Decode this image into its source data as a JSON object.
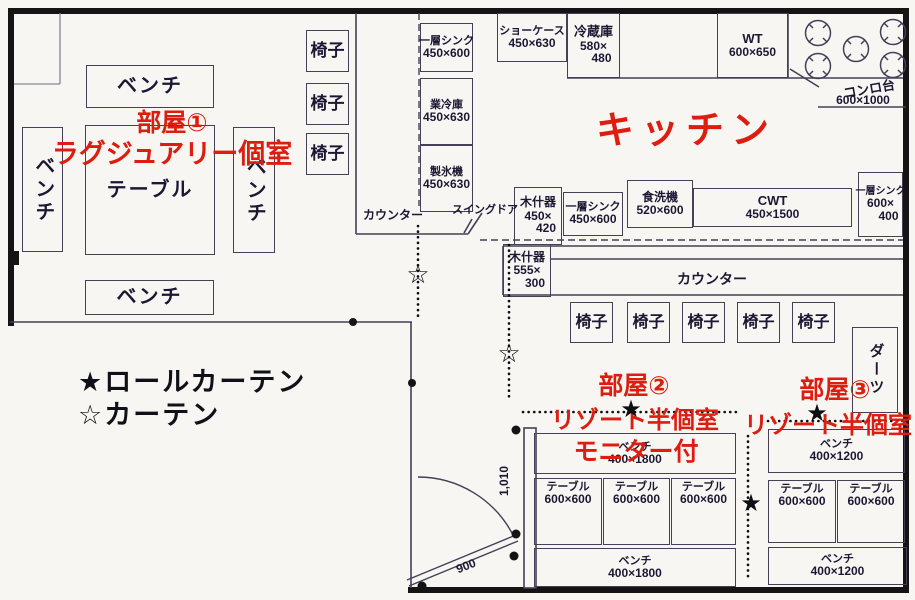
{
  "colors": {
    "accent_red": "#dd1d10",
    "line": "#463f56",
    "wall": "#141414",
    "paper": "#f8f6f2"
  },
  "legend": {
    "roll_curtain": "★ロールカーテン",
    "curtain": "☆カーテン"
  },
  "symbols": {
    "roll_curtain": "★",
    "curtain": "☆"
  },
  "room1": {
    "title": "部屋①",
    "subtitle": "ラグジュアリー個室",
    "bench": "ベンチ",
    "table": "テーブル",
    "chair": "椅子"
  },
  "kitchen": {
    "title": "キッチン",
    "counter": "カウンター",
    "counter_left": "カウンター",
    "swing_door": "スイングドア",
    "chair": "椅子",
    "darts": "ダーツ",
    "sink_left": {
      "name": "一層シンク",
      "dims": "450×600"
    },
    "cooler": {
      "name": "業冷庫",
      "dims": "450×630"
    },
    "ice_maker": {
      "name": "製氷機",
      "dims": "450×630"
    },
    "showcase": {
      "name": "ショーケース",
      "dims": "450×630"
    },
    "refrigerator": {
      "name": "冷蔵庫",
      "dims_a": "580×",
      "dims_b": "480"
    },
    "work_table": {
      "name": "WT",
      "dims": "600×650"
    },
    "stove": {
      "name": "コンロ台",
      "dims": "600×1000"
    },
    "wood_fixture_upper": {
      "name": "木什器",
      "dims_a": "450×",
      "dims_b": "420"
    },
    "sink_center": {
      "name": "一層シンク",
      "dims": "450×600"
    },
    "dishwasher": {
      "name": "食洗機",
      "dims": "520×600"
    },
    "cwt": {
      "name": "CWT",
      "dims": "450×1500"
    },
    "sink_right": {
      "name": "一層シンク",
      "dims_a": "600×",
      "dims_b": "400"
    },
    "wood_fixture_lower": {
      "name": "木什器",
      "dims_a": "555×",
      "dims_b": "300"
    }
  },
  "room2": {
    "title": "部屋②",
    "subtitle": "リゾート半個室",
    "note": "モニター付",
    "bench": "ベンチ",
    "bench_dims": "400×1800",
    "table": "テーブル",
    "table_dims": "600×600"
  },
  "room3": {
    "title": "部屋③",
    "subtitle": "リゾート半個室",
    "bench": "ベンチ",
    "bench_dims": "400×1200",
    "table": "テーブル",
    "table_dims": "600×600"
  },
  "dims": {
    "entry": "1,010",
    "door": "900"
  }
}
